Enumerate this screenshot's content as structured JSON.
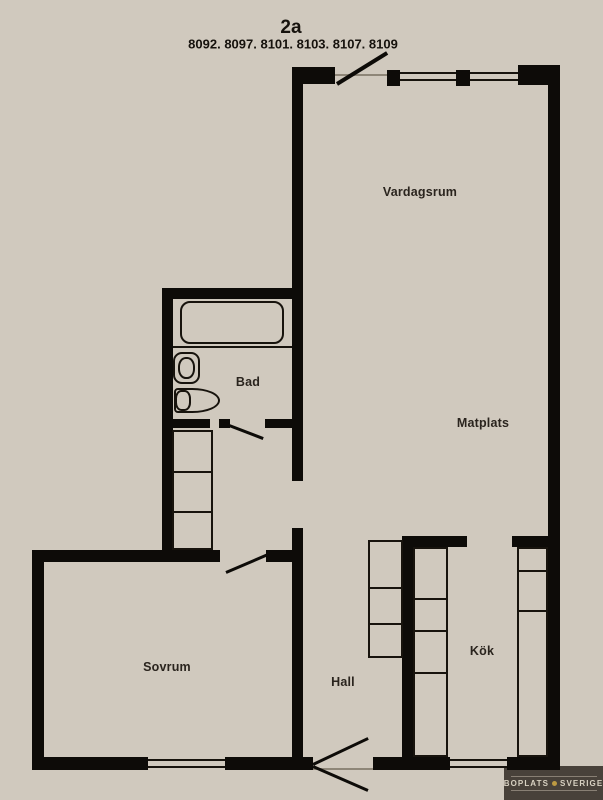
{
  "title": "2a",
  "unit_numbers": "8092. 8097. 8101. 8103. 8107. 8109",
  "rooms": {
    "vardagsrum": {
      "label": "Vardagsrum"
    },
    "matplats": {
      "label": "Matplats"
    },
    "bad": {
      "label": "Bad"
    },
    "sovrum": {
      "label": "Sovrum"
    },
    "hall": {
      "label": "Hall"
    },
    "kok": {
      "label": "Kök"
    }
  },
  "watermark": {
    "left": "BOPLATS",
    "right": "SVERIGE"
  },
  "colors": {
    "background": "#d0c9be",
    "wall": "#0d0b08",
    "label_text": "#2a241e",
    "watermark_bg": "#3d372f",
    "watermark_text": "#d8d1c2",
    "watermark_accent": "#bd9a42"
  }
}
